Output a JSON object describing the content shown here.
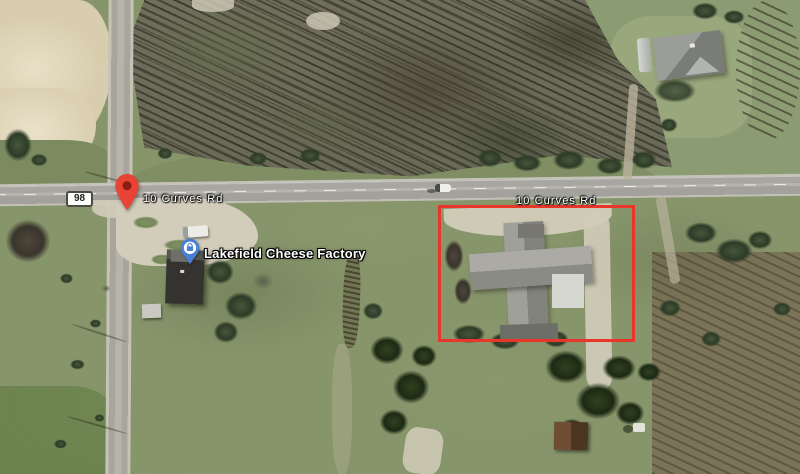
{
  "map": {
    "road_shield": {
      "label": "98"
    },
    "road_labels": {
      "west": "10 Curves Rd",
      "east": "10 Curves Rd"
    },
    "poi": {
      "label": "Lakefield Cheese Factory"
    },
    "annotation_rectangle": {
      "shape": "rectangle",
      "color": "#e8362a"
    },
    "colors": {
      "destination_pin": "#e94335",
      "destination_pin_outline": "#a6281b",
      "destination_pin_dot": "#8c1d12",
      "poi_pin": "#4a7fd6",
      "poi_pin_outline": "#2f5cb0",
      "poi_glyph": "#4a7fd6",
      "road_label_text": "#ffffff",
      "shield_text": "#202020"
    }
  }
}
